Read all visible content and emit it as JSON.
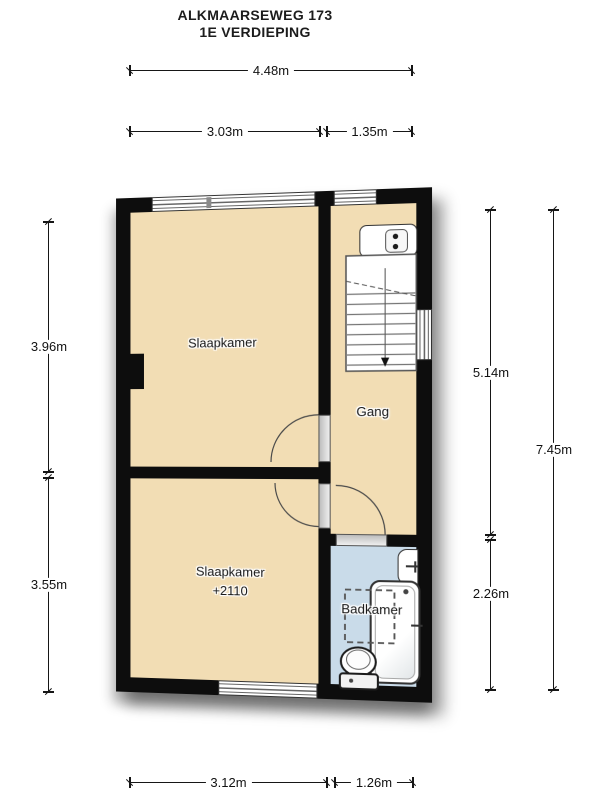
{
  "title": {
    "line1": "ALKMAARSEWEG 173",
    "line2": "1E VERDIEPING"
  },
  "floorplan": {
    "rooms": {
      "slaapkamer_1": "Slaapkamer",
      "gang": "Gang",
      "slaapkamer_2": "Slaapkamer",
      "slaapkamer_2_height": "+2110",
      "badkamer": "Badkamer"
    },
    "colors": {
      "walls": "#0d0d0d",
      "floor": "#f2ddb4",
      "bathroom_floor": "#c9dbe9"
    },
    "fixtures": [
      "stairs",
      "washbasin",
      "bathroom-sink",
      "bathtub",
      "toilet",
      "shower-area",
      "windows",
      "door-swings",
      "chimney-breast"
    ]
  },
  "dimensions": {
    "top_total": "4.48m",
    "top_left": "3.03m",
    "top_right": "1.35m",
    "left_upper": "3.96m",
    "left_lower": "3.55m",
    "right_upper": "5.14m",
    "right_lower": "2.26m",
    "right_total": "7.45m",
    "bottom_left": "3.12m",
    "bottom_right": "1.26m"
  }
}
